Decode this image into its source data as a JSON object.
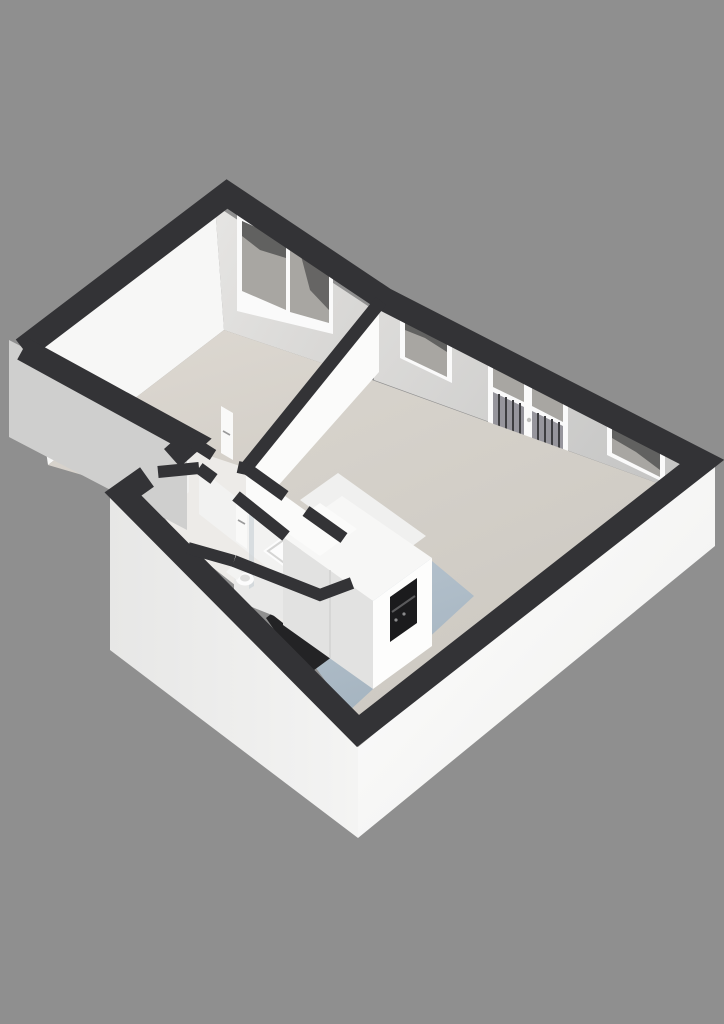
{
  "scene": {
    "type": "3d-floorplan-render",
    "description": "Isometric dollhouse 3D floor plan of a one-bedroom apartment viewed from the south-east, no text labels",
    "background": "#8f8f8f"
  },
  "colors": {
    "background": "#8f8f8f",
    "wall_top": "#333336",
    "wall_exterior_se": "#f6f6f5",
    "wall_exterior_sw": "#efefee",
    "wall_exterior_shaded": "#cfcfce",
    "wall_interior_bright": "#fbfbfa",
    "wall_interior_soft": "#f2f2f1",
    "wall_ne_bedroom": "#dedddb",
    "wall_ne_living": "#d3d2d0",
    "wall_nw_face": "#f7f7f6",
    "floor_bedroom": "#d9d5ce",
    "floor_living": "#d3cfc8",
    "floor_service": "#edebe8",
    "floor_kitchen_blue": "#aebcc8",
    "floor_threshold_dark": "#232325",
    "window_frame": "#fafafa",
    "glass": "#a8a6a2",
    "glass_reflection_dark": "#4a4a4a",
    "balustrade_bar": "#3d3d40",
    "kitchen_top": "#f7f7f6",
    "kitchen_front": "#fdfdfc",
    "kitchen_side": "#e2e2e1",
    "oven_recess": "#1b1b1d",
    "fixture_white": "#fcfcfc",
    "fixture_rim": "#cccccb",
    "shower_glass": "#c3ccd2",
    "utility_red": "#a03a2a",
    "utility_dark": "#2a2a2c",
    "door_leaf": "#f9f9f8",
    "door_handle": "#9a9a9a"
  },
  "rooms": [
    {
      "id": "bedroom",
      "label": "bedroom",
      "position": "top-left wing"
    },
    {
      "id": "living-room",
      "label": "living room",
      "position": "right wing"
    },
    {
      "id": "hallway",
      "label": "hallway",
      "position": "center"
    },
    {
      "id": "bathroom",
      "label": "bathroom with shower and toilet",
      "position": "center-south"
    },
    {
      "id": "utility-closet",
      "label": "utility / meter closet",
      "position": "west corner"
    },
    {
      "id": "kitchen-area",
      "label": "open kitchen with blue-grey floor",
      "position": "south"
    }
  ],
  "openings": {
    "bedroom_window_panes": 2,
    "living_windows": 2,
    "french_door_leaves": 2,
    "interior_doors": 4,
    "entrance_door": 1
  },
  "fixtures": [
    "kitchen-unit-with-oven",
    "shower-tray",
    "shower-glass-panel",
    "toilet",
    "utility-shelf"
  ]
}
